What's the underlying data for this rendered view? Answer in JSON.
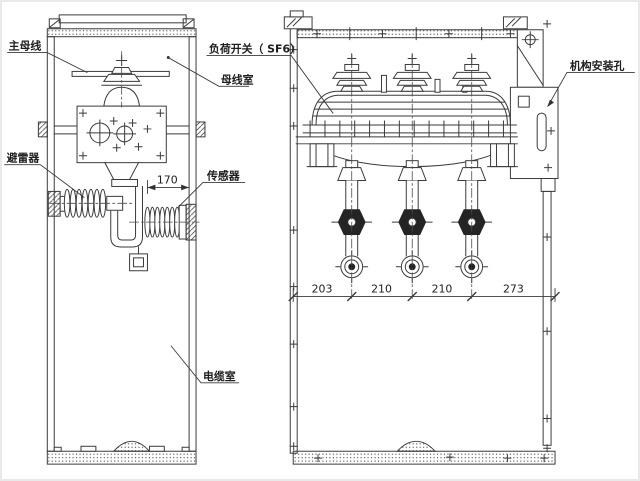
{
  "diagram": {
    "labels": {
      "main_busbar": "主母线",
      "busbar_room": "母线室",
      "load_switch": "负荷开关（ SF6）",
      "arrester": "避雷器",
      "sensor": "传感器",
      "cable_room": "电缆室",
      "mechanism_plate": "机构安装孔"
    },
    "dimensions": {
      "sensor_offset": "170",
      "span_1": "203",
      "span_2": "210",
      "span_3": "210",
      "span_4": "273"
    },
    "line_color": "#3a3a3a",
    "background": "#ffffff"
  }
}
